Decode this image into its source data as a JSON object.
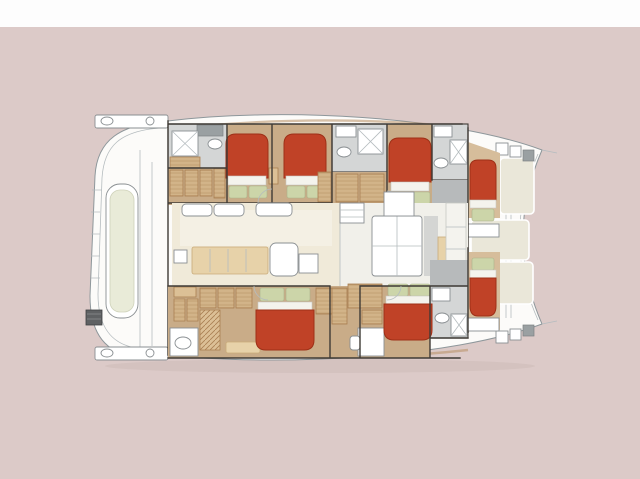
{
  "diagram": {
    "title": "Catamaran yacht interior deck plan, top view, bow facing right",
    "type": "boat-floor-plan",
    "orientation": "bow-right",
    "rooms": [
      {
        "id": "aft-platform",
        "label": "Aft swim platform and davits"
      },
      {
        "id": "aft-cockpit",
        "label": "Aft cockpit with bench seat"
      },
      {
        "id": "port-aft-bathroom",
        "label": "Port aft bathroom"
      },
      {
        "id": "port-aft-cabin",
        "label": "Port aft double cabin"
      },
      {
        "id": "port-mid-cabin",
        "label": "Port mid double cabin"
      },
      {
        "id": "port-mid-bathroom",
        "label": "Port mid bathroom"
      },
      {
        "id": "port-fore-cabin",
        "label": "Port fore double cabin"
      },
      {
        "id": "port-fore-bathroom",
        "label": "Port fore bathroom"
      },
      {
        "id": "port-bow-cabin",
        "label": "Port bow single berth cabin"
      },
      {
        "id": "salon",
        "label": "Salon with dining table"
      },
      {
        "id": "galley",
        "label": "Galley with island"
      },
      {
        "id": "starboard-aft-cabin",
        "label": "Starboard aft double cabin with sofa and WC"
      },
      {
        "id": "starboard-mid-desk",
        "label": "Starboard vanity desk area"
      },
      {
        "id": "starboard-fore-cabin",
        "label": "Starboard fore double cabin"
      },
      {
        "id": "starboard-fore-bathroom",
        "label": "Starboard fore bathroom"
      },
      {
        "id": "starboard-bow-cabin",
        "label": "Starboard bow single berth cabin"
      },
      {
        "id": "foredeck",
        "label": "Foredeck sunpad panels between bows"
      }
    ],
    "furniture": {
      "double_beds": 5,
      "single_bow_beds": 2,
      "toilets": 5,
      "showers": 4,
      "dining_table": 1,
      "galley_island": 1,
      "aft_bench": 1
    }
  },
  "palette": {
    "background": "#dccac8",
    "top_band": "#fdfdfd",
    "hull_white": "#fcfbf9",
    "hull_line": "#8e979b",
    "deck_line": "#b5bcbf",
    "cabin_floor": "#c9ac88",
    "cabin_floor_light": "#d6bd9b",
    "wood": "#dcc096",
    "wood_line": "#a97f52",
    "walls": "#3f3b36",
    "bed_red": "#c04227",
    "bed_red_dark": "#9e3017",
    "linen": "#f4f3ed",
    "pillow_green": "#ccd5a9",
    "salon_floor": "#f0ead9",
    "salon_floor_light": "#f4f0e4",
    "galley_white": "#f1f0ea",
    "bath_gray": "#b7babb",
    "bath_gray_light": "#d4d6d6",
    "fixture_white": "#ffffff",
    "foredeck_panel": "#eae7d9",
    "bench_cushion": "#e9ebd8",
    "table_wood": "#e7d2a9",
    "dark_box": "#5f6163"
  }
}
